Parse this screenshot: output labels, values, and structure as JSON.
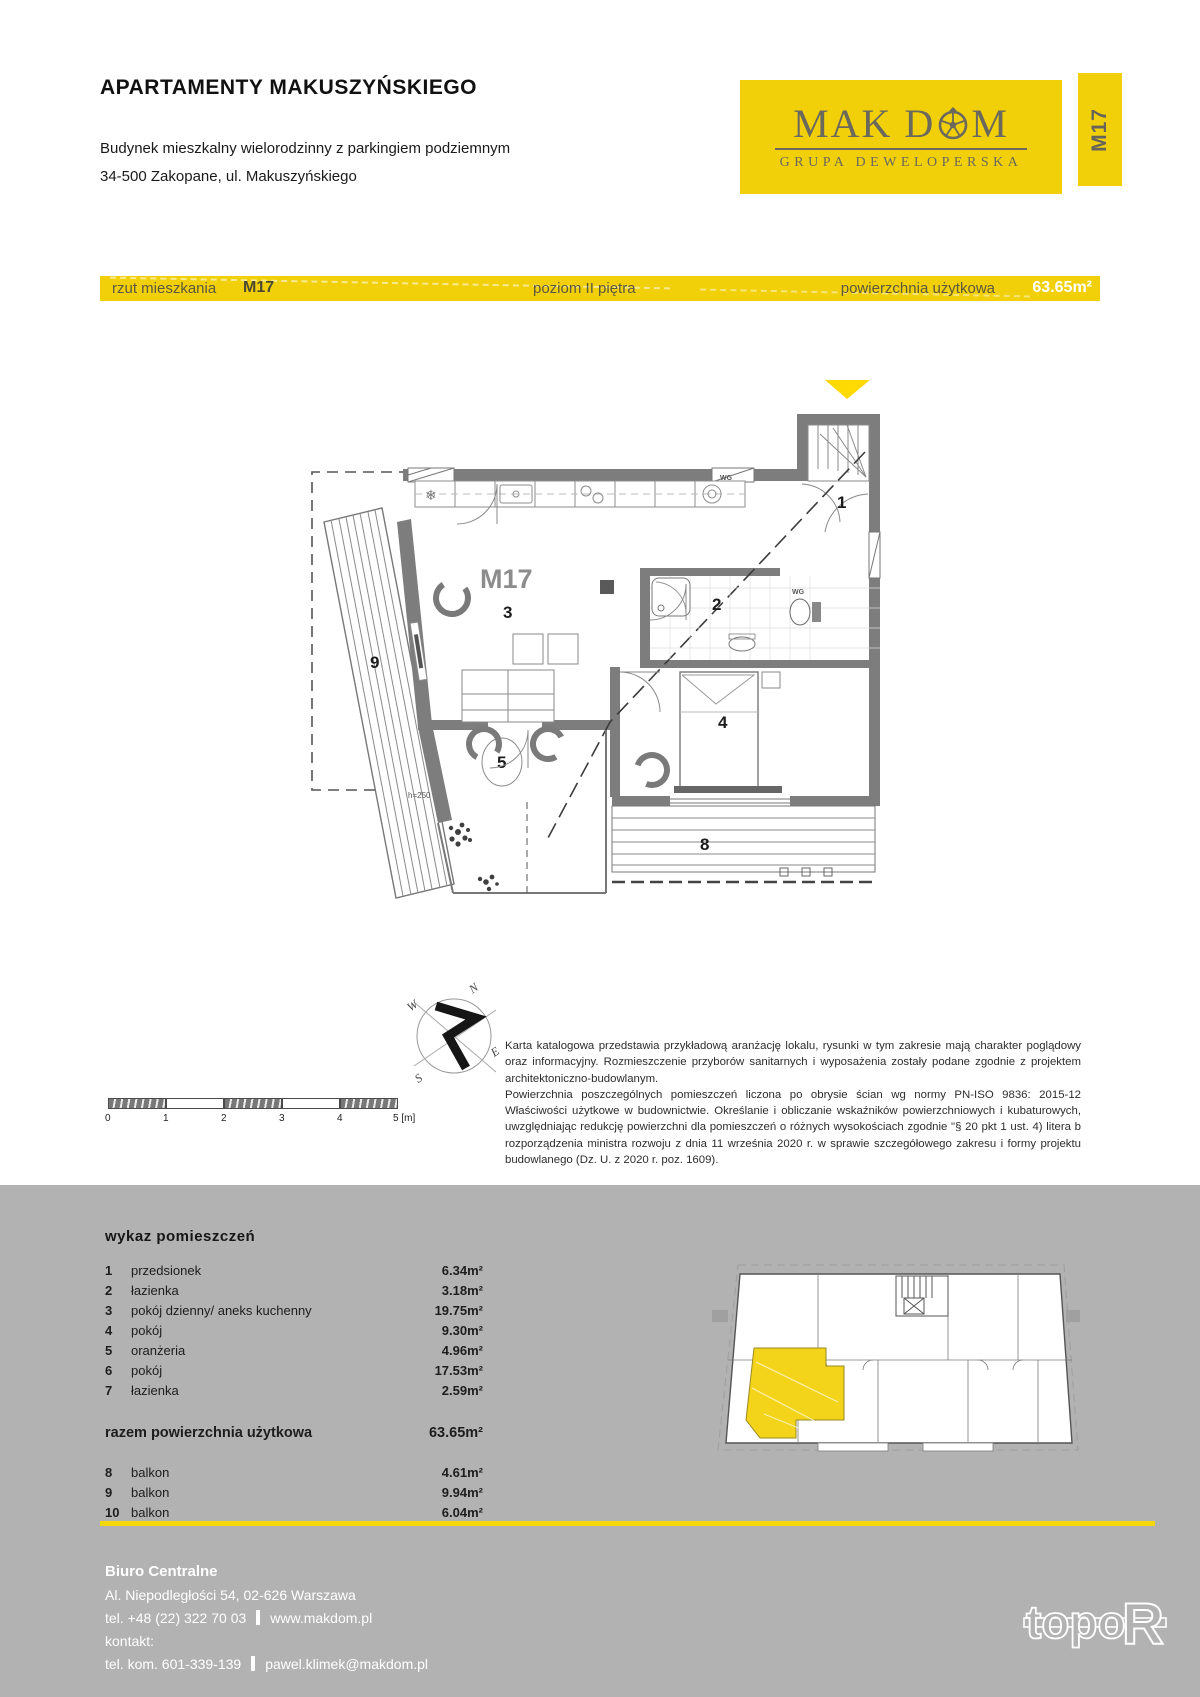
{
  "header": {
    "title": "APARTAMENTY MAKUSZYŃSKIEGO",
    "subtitle_line1": "Budynek mieszkalny wielorodzinny z parkingiem podziemnym",
    "subtitle_line2": "34-500 Zakopane, ul. Makuszyńskiego",
    "brand": {
      "name_part1": "MAK D",
      "name_part2": "M",
      "tagline": "GRUPA DEWELOPERSKA"
    },
    "unit_tab": "M17"
  },
  "info_bar": {
    "plan_label": "rzut mieszkania",
    "unit": "M17",
    "level": "poziom II piętra",
    "area_label": "powierzchnia użytkowa",
    "area_value": "63.65m²"
  },
  "floor_plan": {
    "unit_label": "M17",
    "labels": {
      "hall": "1",
      "bath": "2",
      "living": "3",
      "bedroom": "4",
      "orangery": "5",
      "balcony8": "8",
      "balcony9": "9"
    },
    "height_note": "h=250",
    "wg_label": "WG",
    "fridge_icon": "❄"
  },
  "scale_bar": {
    "ticks": [
      "0",
      "1",
      "2",
      "3",
      "4",
      "5 [m]"
    ]
  },
  "compass": {
    "n": "N",
    "w": "W",
    "s": "S",
    "e": "E"
  },
  "disclaimer": {
    "para1": "Karta katalogowa przedstawia przykładową aranżację lokalu, rysunki w tym zakresie mają charakter poglądowy oraz informacyjny. Rozmieszczenie przyborów sanitarnych i wyposażenia zostały podane zgodnie z projektem architektoniczno-budowlanym.",
    "para2": "Powierzchnia poszczególnych pomieszczeń liczona po obrysie ścian wg normy PN-ISO 9836: 2015-12 Właściwości użytkowe w budownictwie. Określanie i obliczanie wskaźników powierzchniowych i kubaturowych, uwzględniając redukcję powierzchni dla pomieszczeń o różnych wysokościach zgodnie \"§ 20 pkt 1 ust. 4) litera b rozporządzenia ministra rozwoju z dnia 11 września 2020 r. w sprawie szczegółowego zakresu i formy projektu budowlanego (Dz. U. z 2020 r. poz. 1609)."
  },
  "rooms_table": {
    "title": "wykaz pomieszczeń",
    "rows": [
      {
        "no": "1",
        "name": "przedsionek",
        "area": "6.34m²"
      },
      {
        "no": "2",
        "name": "łazienka",
        "area": "3.18m²"
      },
      {
        "no": "3",
        "name": "pokój dzienny/ aneks kuchenny",
        "area": "19.75m²"
      },
      {
        "no": "4",
        "name": "pokój",
        "area": "9.30m²"
      },
      {
        "no": "5",
        "name": "oranżeria",
        "area": "4.96m²"
      },
      {
        "no": "6",
        "name": "pokój",
        "area": "17.53m²"
      },
      {
        "no": "7",
        "name": "łazienka",
        "area": "2.59m²"
      }
    ],
    "total_label": "razem powierzchnia użytkowa",
    "total_value": "63.65m²",
    "balcony_rows": [
      {
        "no": "8",
        "name": "balkon",
        "area": "4.61m²"
      },
      {
        "no": "9",
        "name": "balkon",
        "area": "9.94m²"
      },
      {
        "no": "10",
        "name": "balkon",
        "area": "6.04m²"
      }
    ]
  },
  "footer": {
    "office": "Biuro Centralne",
    "address": "Al. Niepodległości 54, 02-626 Warszawa",
    "phone": "tel. +48 (22) 322 70 03",
    "website": "www.makdom.pl",
    "contact_label": "kontakt:",
    "mobile": "tel. kom. 601-339-139",
    "email": "pawel.klimek@makdom.pl",
    "studio_logo_part1": "topo",
    "studio_logo_part2": "R"
  },
  "colors": {
    "yellow": "#f1d00a",
    "yellow_line": "#f5d80a",
    "triangle": "#ffd902",
    "gray_section": "#b2b2b2",
    "highlight_unit": "#f3d41a"
  }
}
